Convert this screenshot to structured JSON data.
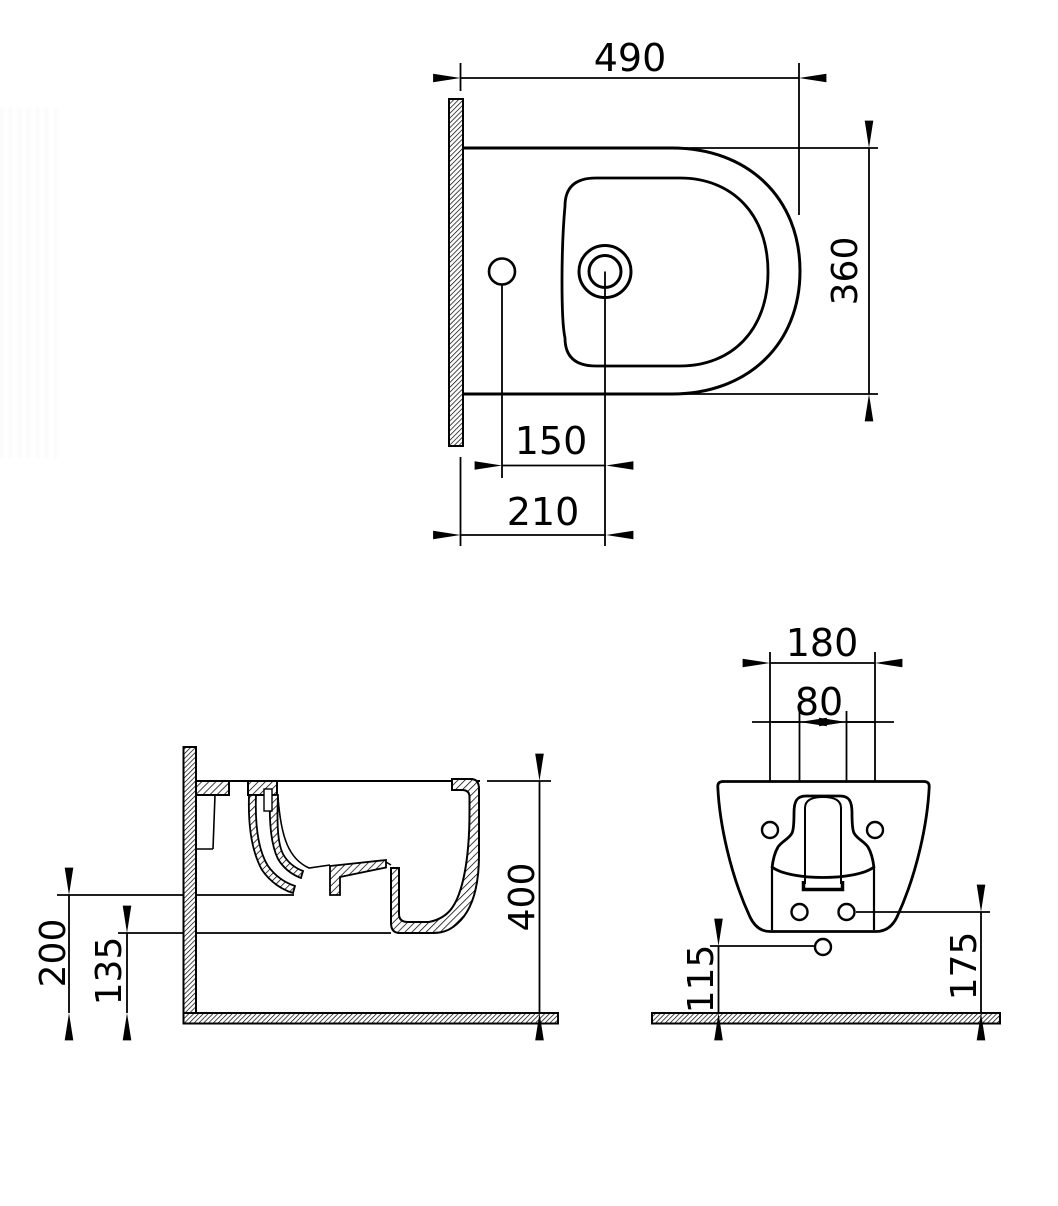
{
  "canvas": {
    "background": "#ffffff",
    "line_color": "#000000",
    "units": "mm",
    "subject": "Wall-hung bidet technical drawing with three orthographic views"
  },
  "views": {
    "top": {
      "label": "top-view",
      "dims": {
        "overall_length": "490",
        "overall_width": "360",
        "tap_to_drain_offset": "150",
        "wall_to_drain_offset": "210"
      }
    },
    "side": {
      "label": "side-section-view",
      "dims": {
        "overall_height": "400",
        "spray_level_height": "200",
        "underside_height": "135"
      }
    },
    "rear": {
      "label": "rear-view",
      "dims": {
        "mounting_hole_spacing": "180",
        "fixing_hole_spacing": "80",
        "outlet_center_height": "115",
        "fixing_hole_height": "175"
      }
    }
  }
}
